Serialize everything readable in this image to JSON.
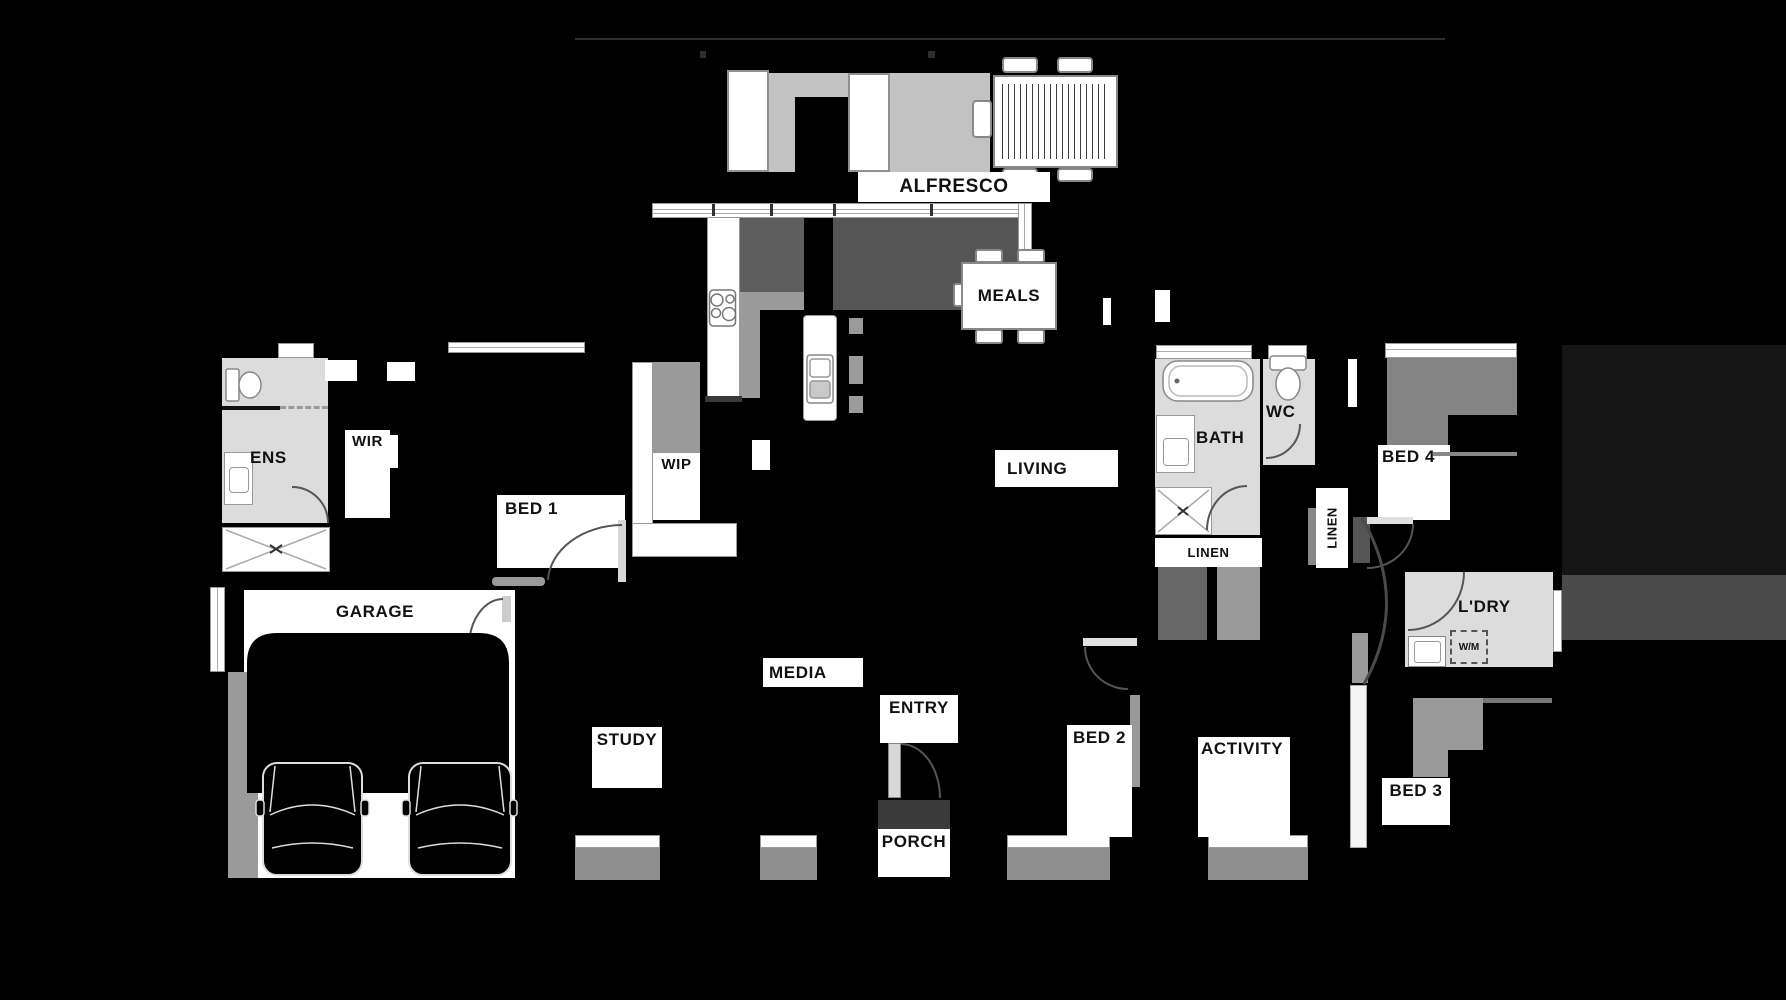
{
  "title": "Single storey house floor plan",
  "colors": {
    "background": "#000000",
    "wet_room_fill": "#dcdcdc",
    "alfresco_fill": "#c2c2c2",
    "rug_fill": "#555555",
    "robe_fill": "#8a8a8a",
    "window_glass": "#8f8f8f",
    "label_background": "#ffffff",
    "label_text": "#111111",
    "boundary_line": "#2e2e2e"
  },
  "labels": {
    "alfresco": "ALFRESCO",
    "meals": "MEALS",
    "wir": "WIR",
    "ens": "ENS",
    "bed1": "BED 1",
    "wip": "WIP",
    "living": "LIVING",
    "bath": "BATH",
    "wc": "WC",
    "linen_main": "LINEN",
    "linen_hall": "LINEN",
    "bed4": "BED 4",
    "ldry": "L'DRY",
    "wm": "W/M",
    "garage": "GARAGE",
    "media": "MEDIA",
    "study": "STUDY",
    "entry": "ENTRY",
    "porch": "PORCH",
    "bed2": "BED 2",
    "activity": "ACTIVITY",
    "bed3": "BED 3"
  }
}
